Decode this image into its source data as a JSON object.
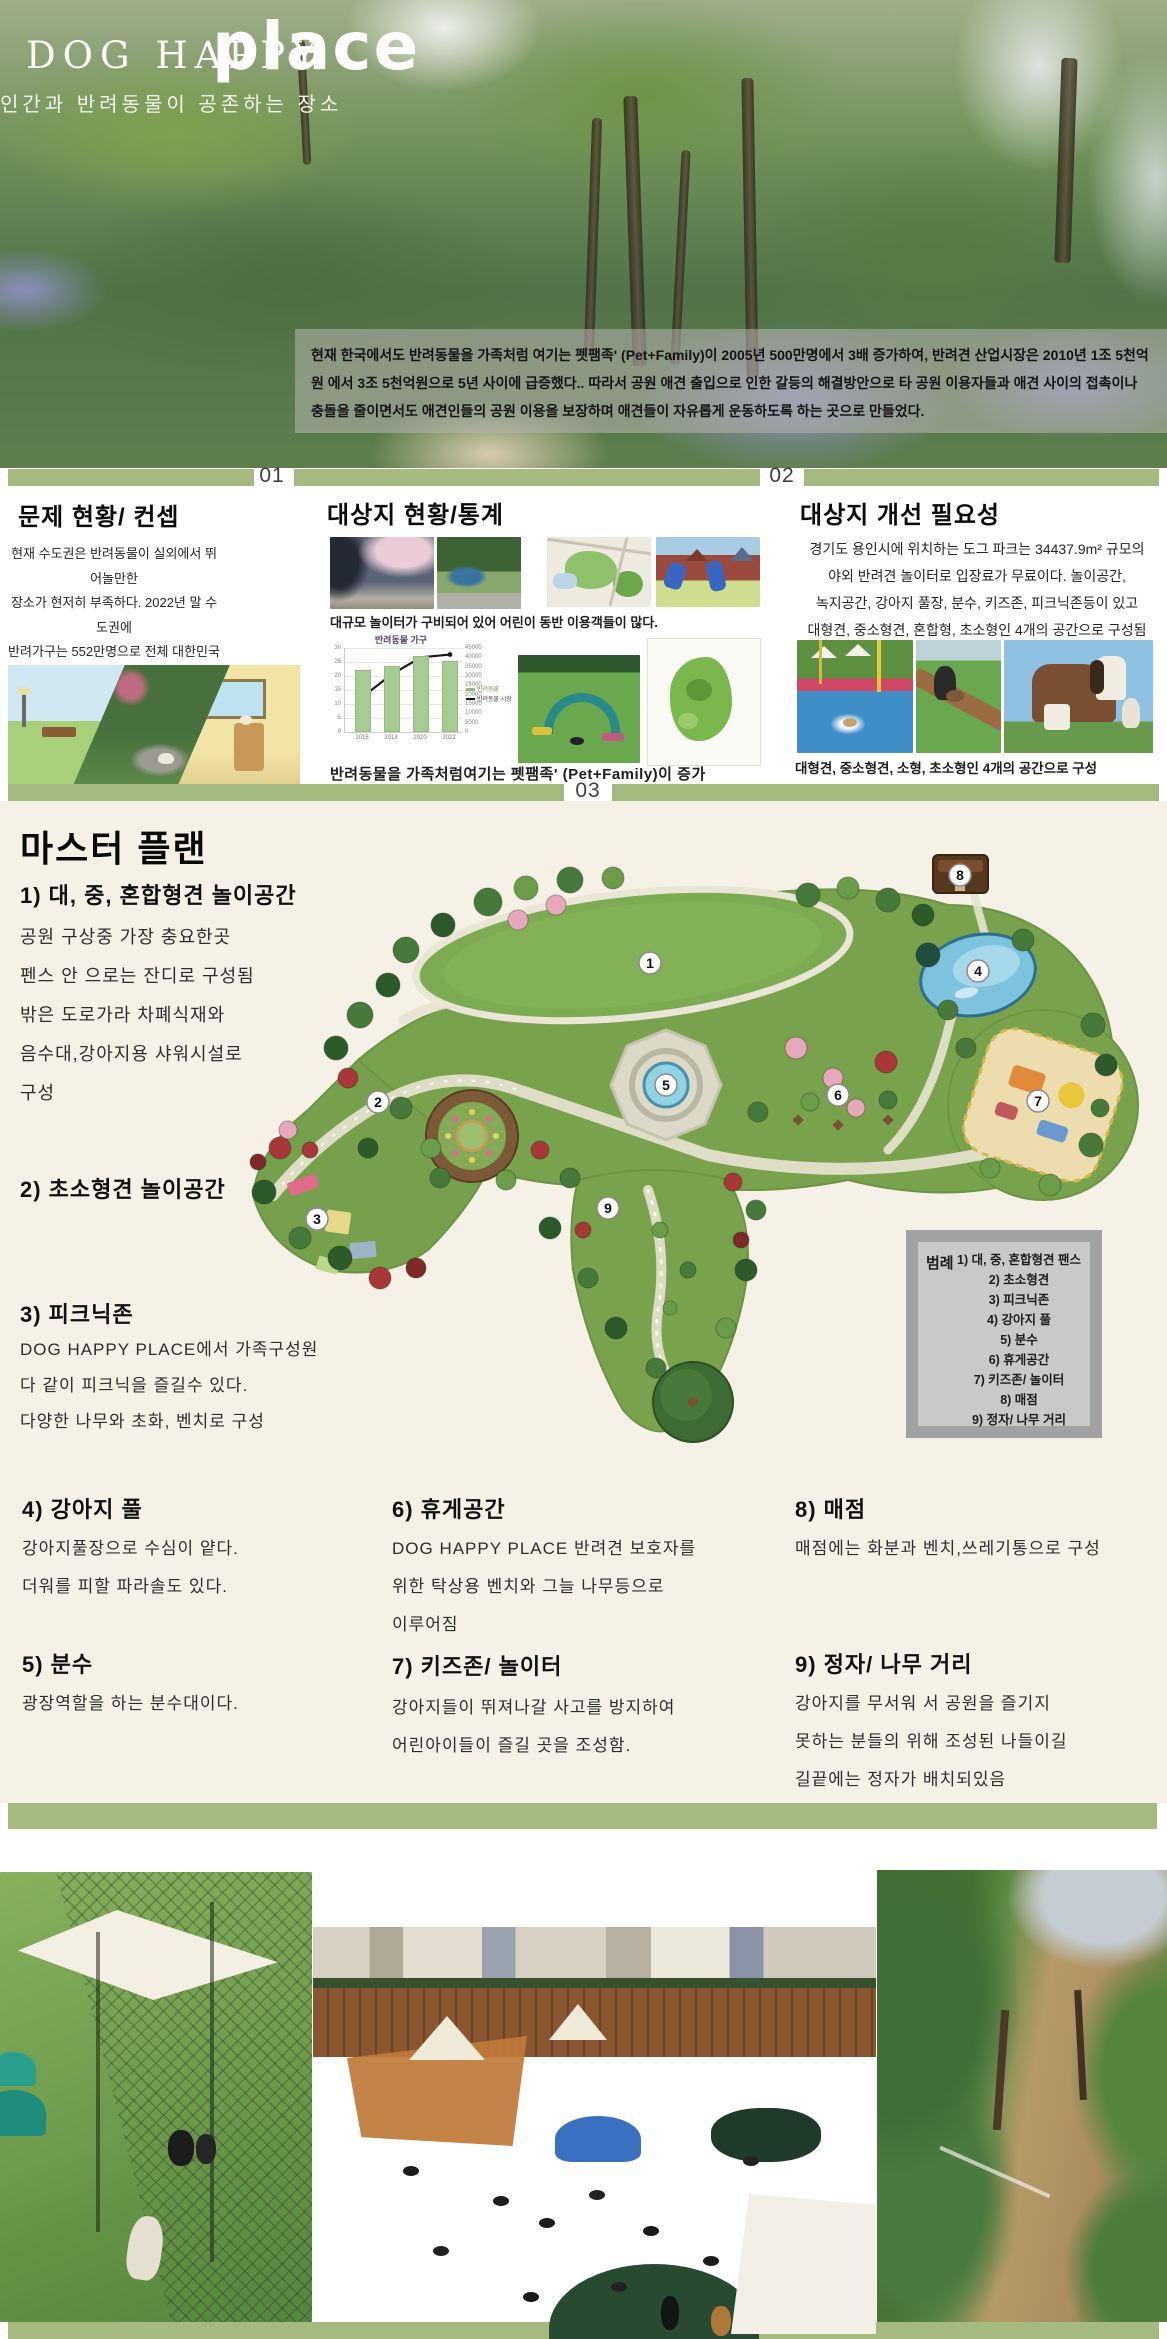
{
  "header": {
    "title_line": "DOG HAPPY",
    "title_accent": "place",
    "subtitle": "인간과 반려동물이 공존하는 장소",
    "intro": "현재 한국에서도 반려동물을 가족처럼 여기는 펫팸족' (Pet+Family)이 2005년 500만명에서 3배 증가하여, 반려견 산업시장은 2010년 1조 5천억원 에서 3조 5천억원으로 5년 사이에 급증했다.. 따라서 공원 애견 출입으로 인한 갈등의 해결방안으로 타 공원 이용자들과 애견 사이의 접촉이나 충돌을 줄이면서도 애견인들의 공원 이용을 보장하며 애견들이 자유롭게 운동하도록 하는 곳으로 만들었다."
  },
  "dividers": {
    "d1": "01",
    "d2": "02",
    "d3": "03"
  },
  "sections": {
    "problem": {
      "title": "문제 현황/ 컨셉",
      "body": "현재 수도권은 반려동물이 실외에서 뛰어놀만한\n장소가 현저히 부족하다. 2022년 말 수도권에\n반려가구는 552만명으로 전체 대한민국\n반려가구의 절반 정도가 거주하고있다.\n하지만 반려인이 마음 놓고 뛰어놀 장소는\n단 두곳을 제외하고는 찾아볼 수가 없었다."
    },
    "site": {
      "title": "대상지 현황/통계",
      "caption_top": "대규모 놀이터가 구비되어 있어 어린이 동반 이용객들이 많다.",
      "caption_bottom": "반려동물을 가족처럼여기는 펫팸족' (Pet+Family)이 증가"
    },
    "need": {
      "title": "대상지 개선 필요성",
      "body": "경기도 용인시에 위치하는 도그 파크는 34437.9m² 규모의\n야외 반려견 놀이터로 입장료가 무료이다. 놀이공간,\n녹지공간, 강아지 풀장, 분수, 키즈존, 피크닉존등이 있고\n대형견, 중소형견, 혼합형, 초소형인 4개의 공간으로 구성됨",
      "caption": "대형견, 중소형견, 소형, 초소형인 4개의 공간으로 구성"
    }
  },
  "chart_data": {
    "type": "bar",
    "title": "반려동물 가구",
    "categories": [
      "2015",
      "2018",
      "2020",
      "2022"
    ],
    "series": [
      {
        "name": "반려동물",
        "type": "bar",
        "axis": "left",
        "values": [
          22,
          23.5,
          27,
          25.5
        ]
      },
      {
        "name": "반려동물 시장",
        "type": "line",
        "axis": "right",
        "values": [
          19000,
          31000,
          40000,
          41500
        ]
      }
    ],
    "left_axis": {
      "min": 0,
      "max": 30,
      "step": 5
    },
    "right_axis": {
      "min": 0,
      "max": 45000,
      "step": 5000
    },
    "legend_position": "right",
    "colors": {
      "bar": "#a6cc92",
      "line": "#1a1a1a"
    }
  },
  "master": {
    "title": "마스터 플랜",
    "items": [
      {
        "heading": "1) 대, 중, 혼합형견 ",
        "heading_bold": "놀이공간",
        "body": "공원 구상중 가장 충요한곳\n펜스 안 으로는 잔디로 구성됨\n밖은 도로가라 차폐식재와\n음수대,강아지용 샤워시설로\n구성"
      },
      {
        "heading": "2) 초소형견 ",
        "heading_bold": "놀이공간",
        "body": ""
      },
      {
        "heading": "3) 피크닉존",
        "heading_bold": "",
        "body": "DOG HAPPY PLACE에서 가족구성원\n다 같이 피크닉을 즐길수 있다.\n다양한 나무와 초화, 벤치로 구성"
      },
      {
        "heading": "4) 강아지 풀",
        "heading_bold": "",
        "body": "강아지풀장으로 수심이 얕다.\n더워를 피할 파라솔도 있다."
      },
      {
        "heading": "5) 분수",
        "heading_bold": "",
        "body": "광장역할을 하는 분수대이다."
      },
      {
        "heading": "6) 휴게공간",
        "heading_bold": "",
        "body": "DOG HAPPY PLACE 반려견 보호자를\n위한 탁상용 벤치와 그늘 나무등으로\n이루어짐"
      },
      {
        "heading": "7) 키즈존/ 놀이터",
        "heading_bold": "",
        "body": "강아지들이 뛰져나갈 사고를 방지하여\n어린아이들이 즐길 곳을 조성함."
      },
      {
        "heading": "8) 매점",
        "heading_bold": "",
        "body": "매점에는 화분과 벤치,쓰레기통으로 구성"
      },
      {
        "heading": "9) 정자/ 나무 거리",
        "heading_bold": "",
        "body": "강아지를 무서워 서 공원을 즐기지\n못하는 분들의 위해 조성된 나들이길\n길끝에는 정자가 배치되있음"
      }
    ],
    "badges": [
      "1",
      "2",
      "3",
      "4",
      "5",
      "6",
      "7",
      "8",
      "9"
    ]
  },
  "legend": {
    "label": "범례",
    "items": [
      "1) 대, 중, 혼합형견 팬스",
      "2) 초소형견",
      "3) 피크닉존",
      "4) 강아지 풀",
      "5) 분수",
      "6) 휴게공간",
      "7) 키즈존/ 놀이터",
      "8) 매점",
      "9) 정자/ 나무 거리"
    ]
  },
  "colors": {
    "accent_green": "#a4ba7e",
    "cream_bg": "#f5f1e6",
    "legend_gray": "#a2a2a2"
  }
}
